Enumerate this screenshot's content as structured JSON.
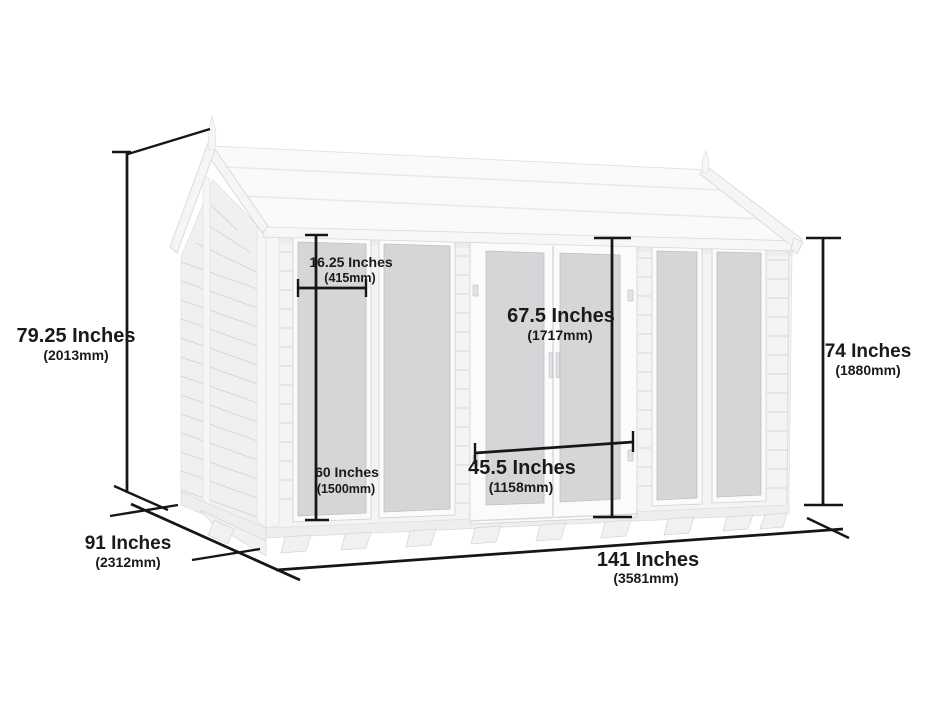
{
  "diagram": {
    "subject": "apex summerhouse shed with glazed windows and double doors",
    "labels": {
      "height_left": {
        "inches": "79.25 Inches",
        "mm": "(2013mm)"
      },
      "depth": {
        "inches": "91 Inches",
        "mm": "(2312mm)"
      },
      "width": {
        "inches": "141 Inches",
        "mm": "(3581mm)"
      },
      "height_right": {
        "inches": "74 Inches",
        "mm": "(1880mm)"
      },
      "window_width": {
        "inches": "16.25 Inches",
        "mm": "(415mm)"
      },
      "window_height": {
        "inches": "60 Inches",
        "mm": "(1500mm)"
      },
      "door_height": {
        "inches": "67.5 Inches",
        "mm": "(1717mm)"
      },
      "door_width": {
        "inches": "45.5 Inches",
        "mm": "(1158mm)"
      }
    },
    "colors": {
      "dimension": "#161616",
      "glass": "#d6d6d8",
      "wall_front": "#f4f4f5",
      "wall_gable": "#eff0f1",
      "roof": "#fafafb",
      "background": "#ffffff"
    }
  }
}
